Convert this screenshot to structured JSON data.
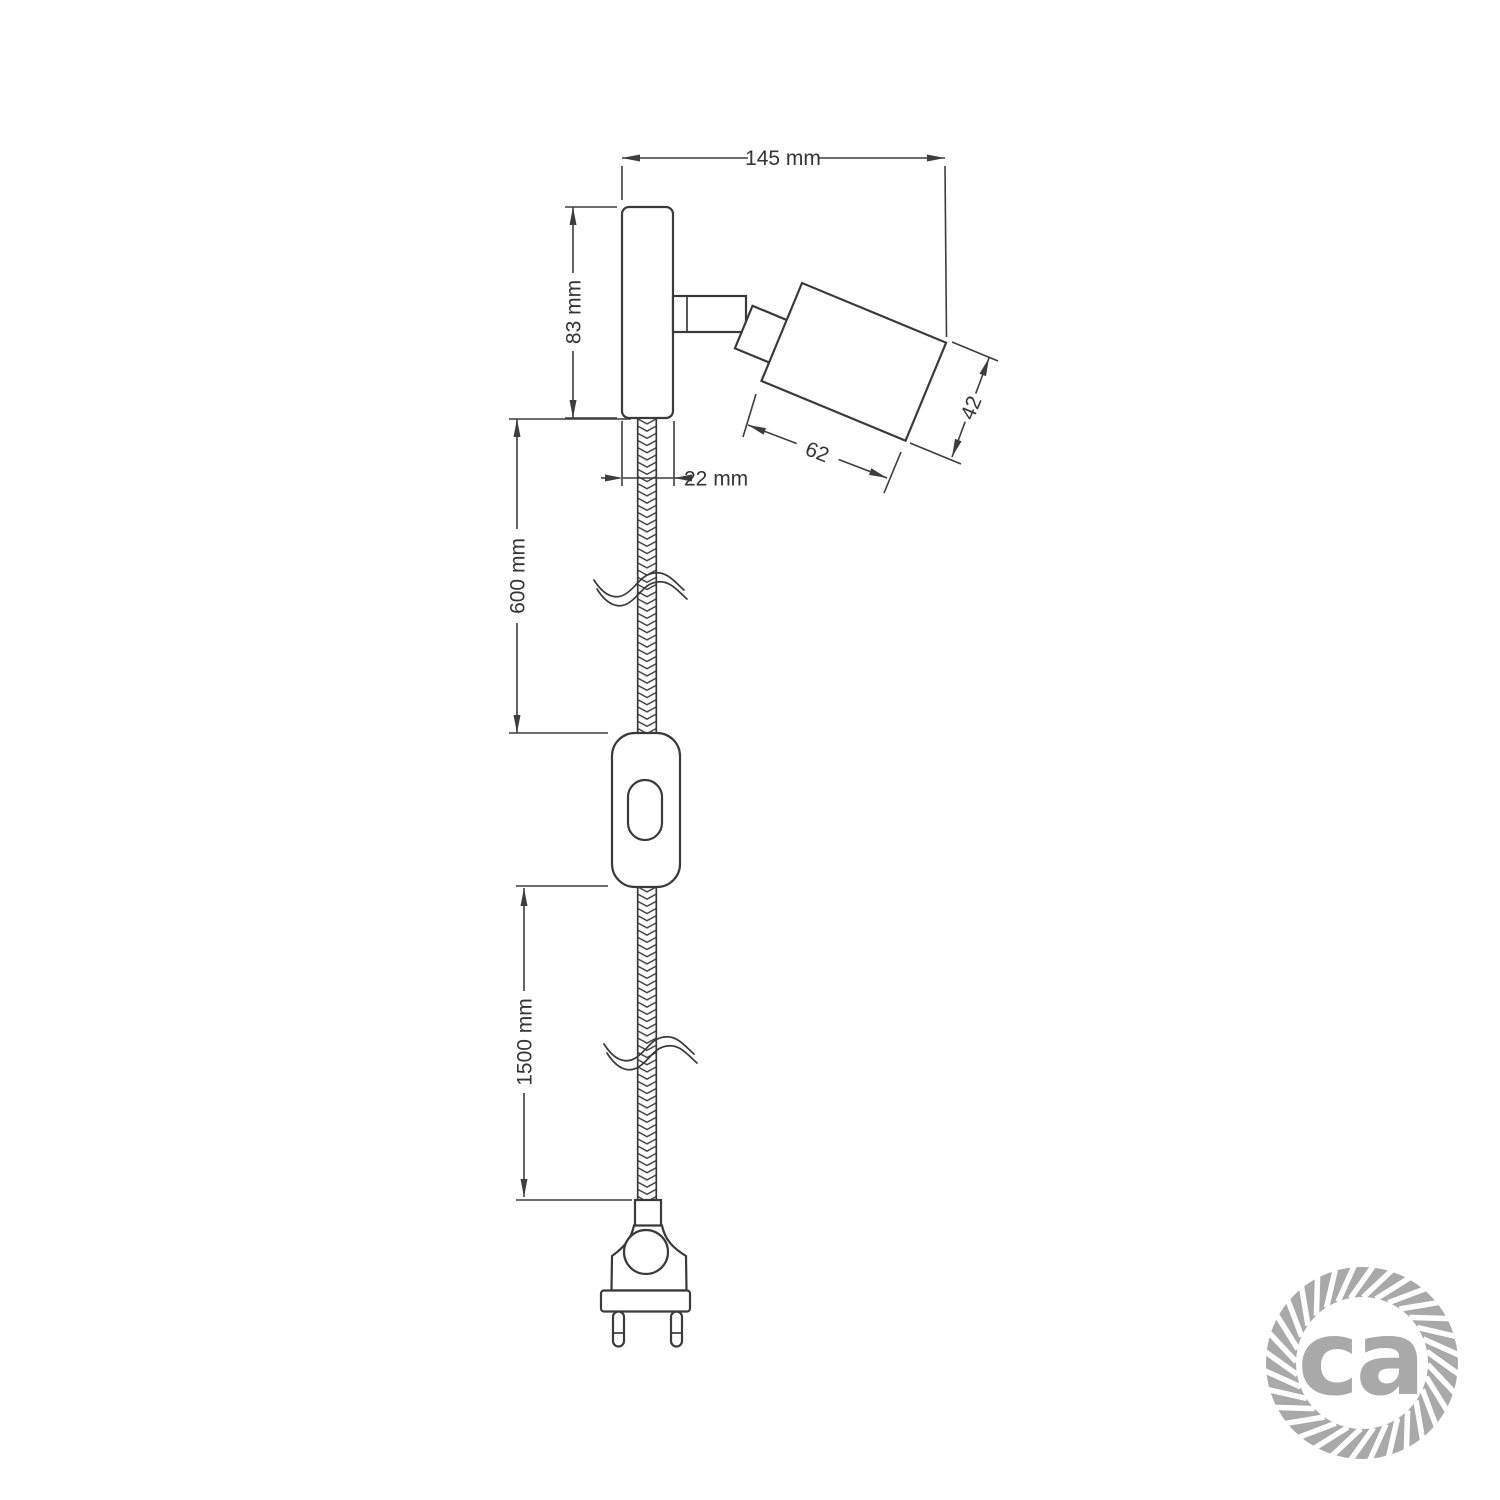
{
  "colors": {
    "line": "#3a3a3a",
    "logo_gray": "#a9a9a9",
    "background": "#ffffff"
  },
  "dimension_labels": {
    "bracket_width": "145 mm",
    "bracket_height": "83 mm",
    "bracket_depth": "22 mm",
    "spotlight_length": "62",
    "spotlight_diameter": "42",
    "cable_upper_section": "600 mm",
    "cable_lower_section": "1500 mm"
  },
  "logo": {
    "text": "ca"
  }
}
